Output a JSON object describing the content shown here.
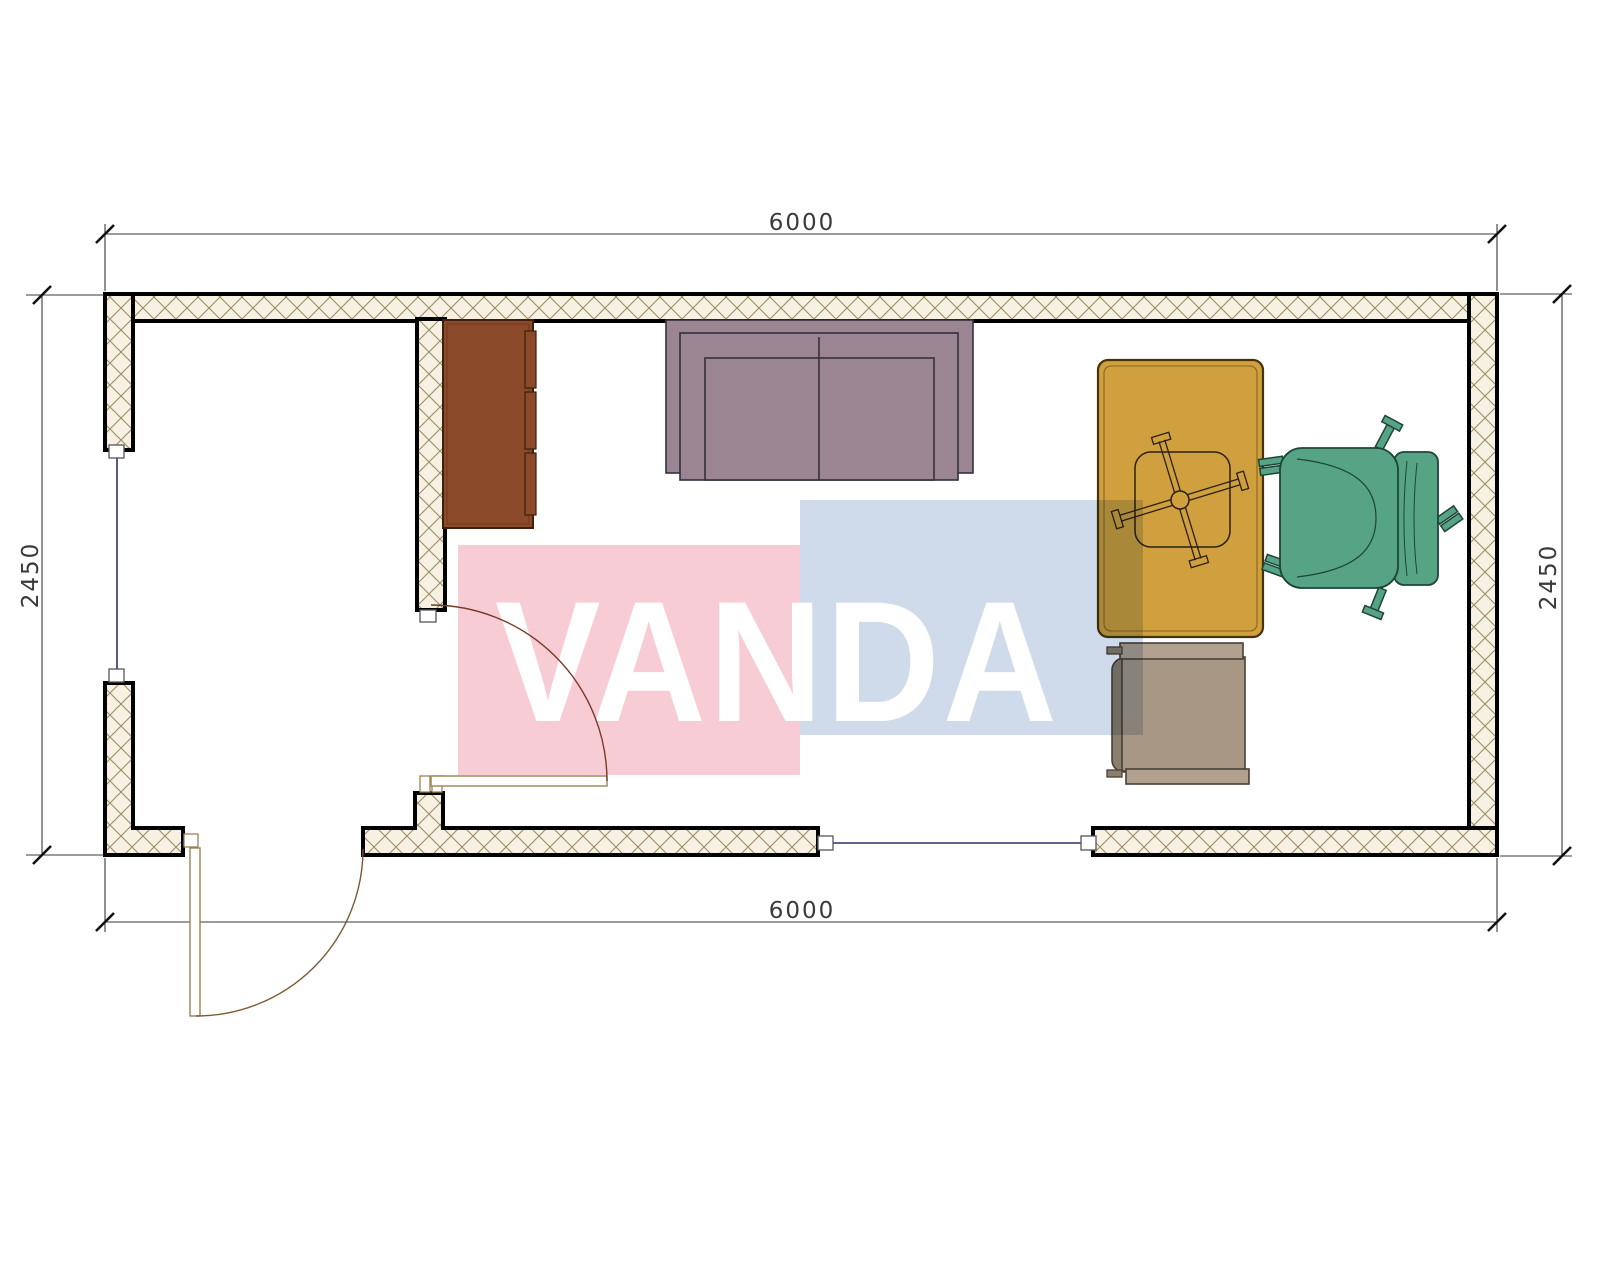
{
  "dimensions": {
    "top": "6000",
    "bottom": "6000",
    "left": "2450",
    "right": "2450"
  },
  "watermark": {
    "text": "VANDA",
    "pink_block_color": "#f8ccd4",
    "blue_block_color": "#cfdbea",
    "text_color": "#ffffff"
  },
  "colors": {
    "wall_hatch_bg": "#f6f1e3",
    "wall_hatch_line": "#9d8d64",
    "wall_outline": "#000000",
    "window_line": "#2c3166",
    "interior_door_arc": "#7a3a28",
    "exterior_door_arc": "#7c5a35",
    "door_frame": "#9b8252",
    "dimension_line": "#3a3a3a",
    "cabinet": "#8b4b2a",
    "sofa": "#9b8593",
    "desk": "#d09f3e",
    "office_chair": "#57a386",
    "side_chair_seat": "#a89785",
    "side_chair_back": "#8b7f6e",
    "side_chair_bar": "#b1a18e"
  },
  "furniture": [
    {
      "name": "cabinet"
    },
    {
      "name": "sofa"
    },
    {
      "name": "desk"
    },
    {
      "name": "desk-stool"
    },
    {
      "name": "office-chair"
    },
    {
      "name": "side-chair"
    }
  ],
  "openings": [
    {
      "name": "interior-door"
    },
    {
      "name": "exterior-door"
    },
    {
      "name": "window-left"
    },
    {
      "name": "window-bottom"
    }
  ]
}
